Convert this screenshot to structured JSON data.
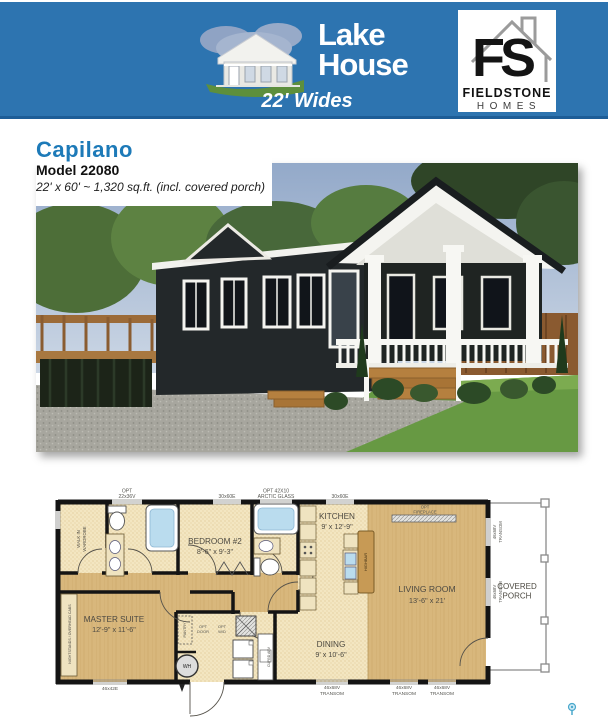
{
  "banner": {
    "color": "#2d74b0",
    "brand_line1": "Lake",
    "brand_line2": "House",
    "tagline": "22' Wides"
  },
  "fieldstone": {
    "monogram": "FS",
    "name": "FIELDSTONE",
    "sub": "HOMES"
  },
  "model": {
    "name": "Capilano",
    "number": "Model 22080",
    "specs": "22' x 60' ~ 1,320 sq.ft. (incl. covered porch)"
  },
  "floorplan": {
    "windows": {
      "top1_l1": "OPT",
      "top1_l2": "22x36V",
      "top2": "30x60E",
      "top3_l1": "OPT 42X10",
      "top3_l2": "ARCTIC GLASS",
      "top4": "30x60E",
      "bottom": "46x42E",
      "transom_size": "46x68V",
      "transom_word": "TRANSOM"
    },
    "rooms": {
      "master_name": "MASTER SUITE",
      "master_dims": "12'-9\" x 11'-6\"",
      "bedroom2_name": "BEDROOM #2",
      "bedroom2_dims": "8'-6\" x 9'-3\"",
      "kitchen_name": "KITCHEN",
      "kitchen_dims": "9' x 12'-9\"",
      "living_name": "LIVING ROOM",
      "living_dims": "13'-6\" x 21'",
      "dining_name": "DINING",
      "dining_dims": "9' x 10'-6\"",
      "porch_l1": "COVERED",
      "porch_l2": "PORCH",
      "wardrobe_l1": "WALK IN",
      "wardrobe_l2": "WARDROBE",
      "nightstands": "NIGHTSTANDS / OVERHEAD CABS"
    },
    "annotations": {
      "fireplace_l1": "OPT",
      "fireplace_l2": "FIREPLACE",
      "opt_door_l1": "OPT",
      "opt_door_l2": "DOOR",
      "opt_wd_l1": "OPT",
      "opt_wd_l2": "W/D",
      "water_heater": "WH",
      "highbar": "HIGHBAR",
      "pantry": "PANTRY",
      "cupboard": "CUPBD ABV"
    }
  }
}
